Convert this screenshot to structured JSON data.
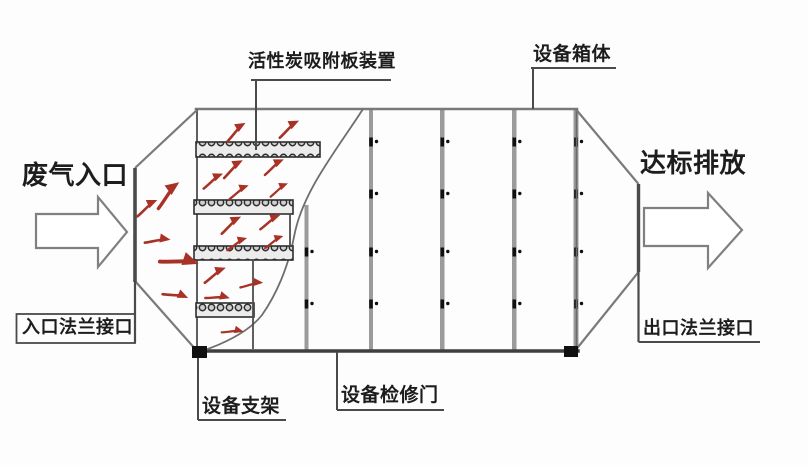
{
  "labels": {
    "waste_gas_inlet": "废气入口",
    "activated_carbon_plates": "活性炭吸附板装置",
    "equipment_cabinet": "设备箱体",
    "discharge": "达标排放",
    "inlet_flange": "入口法兰接口",
    "outlet_flange": "出口法兰接口",
    "equipment_support": "设备支架",
    "access_door": "设备检修门"
  },
  "icons": {
    "inlet_arrow": "hollow-right-arrow",
    "outlet_arrow": "hollow-right-arrow",
    "gas_flow": "red-curved-flow-arrow",
    "bolt": "panel-bolt-dot"
  },
  "colors": {
    "outline": "#6e6e6e",
    "panel_seam": "#9b9b9b",
    "label_text": "#1d1d1d",
    "gas_flow_arrow": "#a93226",
    "support_foot": "#101010",
    "background": "#fdfdfd"
  },
  "structure": {
    "carbon_plate_count": 4,
    "panel_seam_count": 5,
    "bolt_row_count": 4,
    "gas_flow_arrow_count": 20
  }
}
